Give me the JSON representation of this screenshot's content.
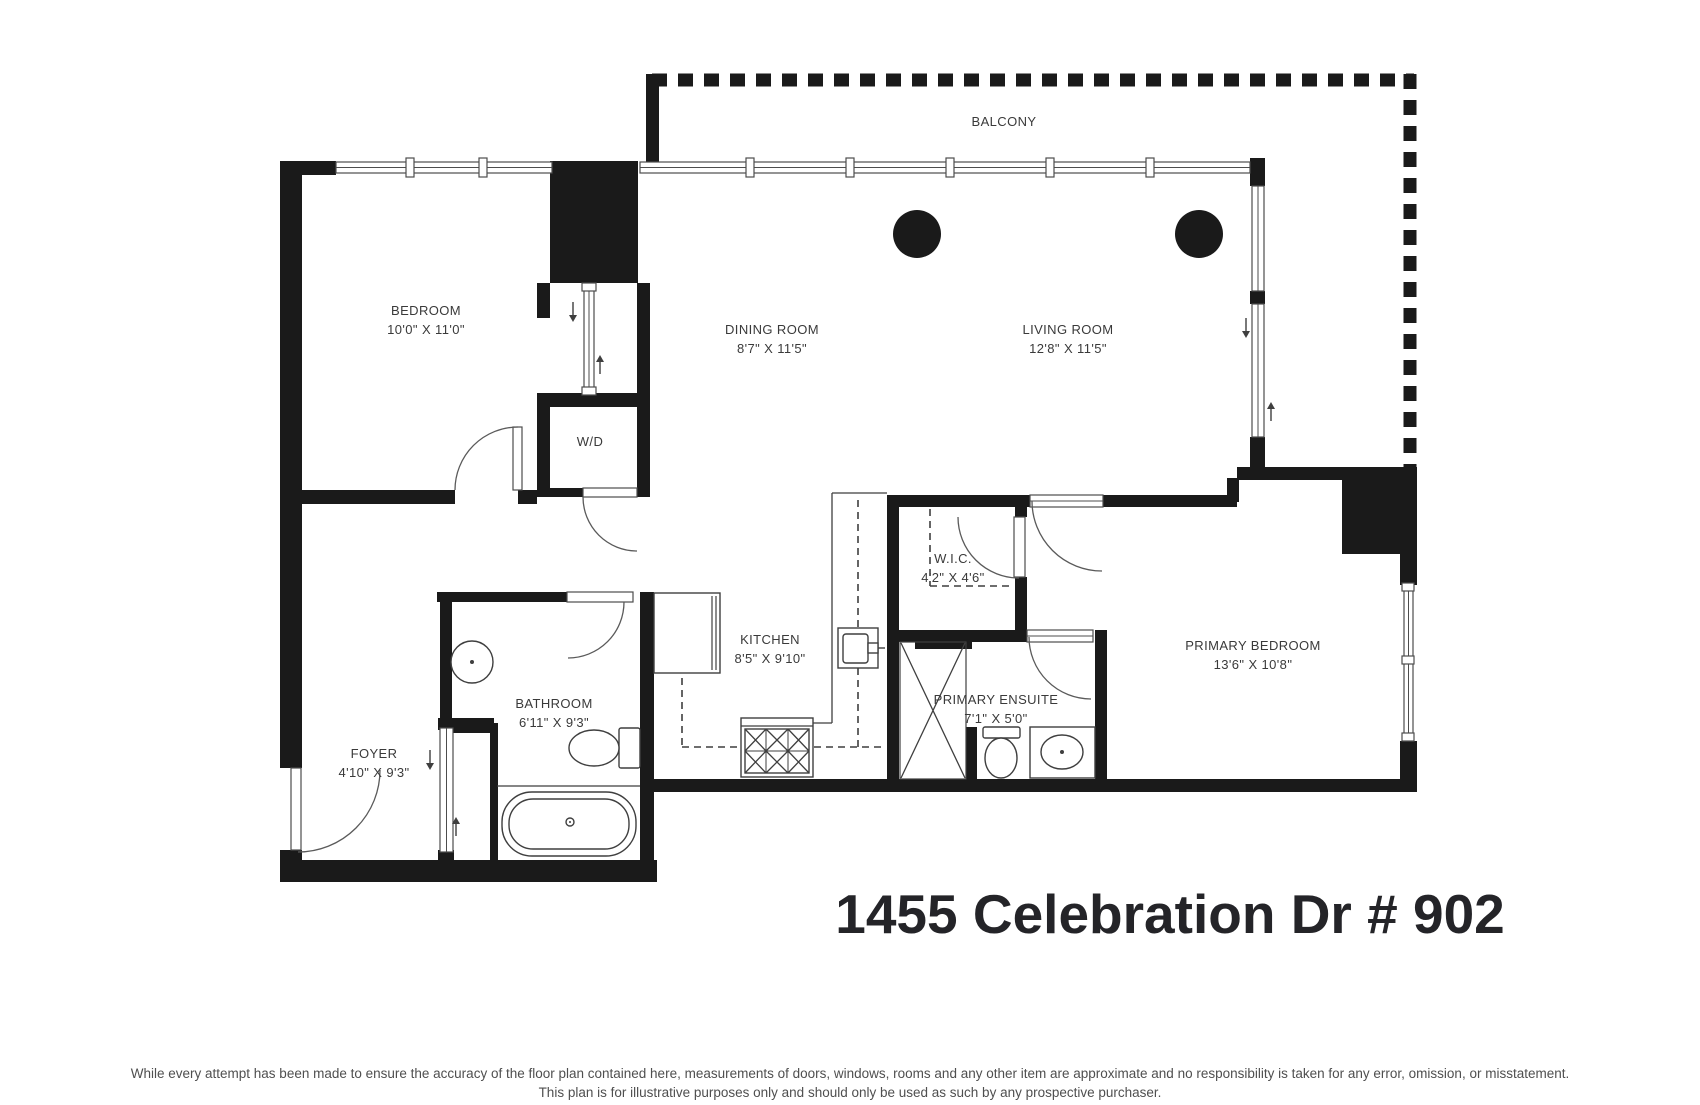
{
  "title": "1455 Celebration Dr # 902",
  "colors": {
    "wall": "#1a1a1a",
    "fixture_line": "#3f3f3f",
    "label_text": "#3a3a3a",
    "title_text": "#242428",
    "disclaimer_text": "#4f4f4f"
  },
  "rooms": {
    "balcony": {
      "name": "BALCONY"
    },
    "bedroom": {
      "name": "BEDROOM",
      "dims": "10'0\" X 11'0\""
    },
    "dining_room": {
      "name": "DINING ROOM",
      "dims": "8'7\" X 11'5\""
    },
    "living_room": {
      "name": "LIVING ROOM",
      "dims": "12'8\" X 11'5\""
    },
    "washer_dryer": {
      "name": "W/D"
    },
    "walk_in_closet": {
      "name": "W.I.C.",
      "dims": "4'2\" X 4'6\""
    },
    "kitchen": {
      "name": "KITCHEN",
      "dims": "8'5\" X 9'10\""
    },
    "bathroom": {
      "name": "BATHROOM",
      "dims": "6'11\" X 9'3\""
    },
    "foyer": {
      "name": "FOYER",
      "dims": "4'10\" X 9'3\""
    },
    "primary_ensuite": {
      "name": "PRIMARY ENSUITE",
      "dims": "7'1\" X 5'0\""
    },
    "primary_bedroom": {
      "name": "PRIMARY BEDROOM",
      "dims": "13'6\" X 10'8\""
    }
  },
  "disclaimer": {
    "line1": "While every attempt has been made to ensure the accuracy of the floor plan contained here, measurements of doors, windows, rooms and any other item are approximate and no responsibility is taken for any error, omission, or misstatement.",
    "line2": "This plan is for illustrative purposes only and should only be used as such by any prospective purchaser."
  }
}
